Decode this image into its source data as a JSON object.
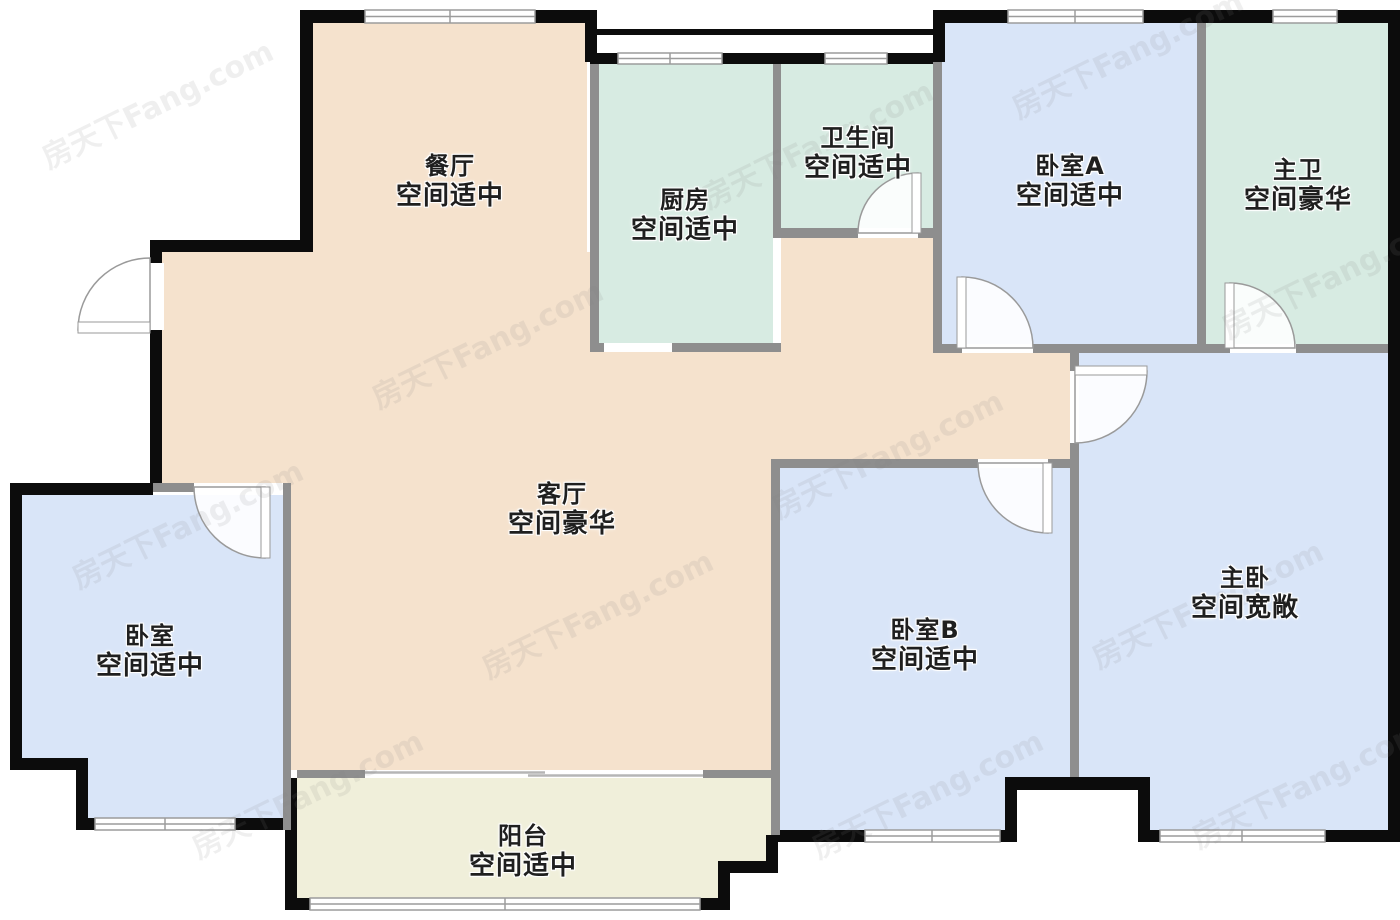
{
  "watermark": "房天下Fang.com",
  "palette": {
    "beige": "#F5E2CD",
    "teal": "#D7EBE2",
    "blue": "#D9E5F8",
    "balcony": "#F0EFDA",
    "wall_black": "#0C0C0C",
    "wall_gray": "#8E8E8E"
  },
  "rooms": [
    {
      "id": "dining",
      "name": "餐厅",
      "size_note": "空间适中"
    },
    {
      "id": "kitchen",
      "name": "厨房",
      "size_note": "空间适中"
    },
    {
      "id": "bathroom",
      "name": "卫生间",
      "size_note": "空间适中"
    },
    {
      "id": "bedroom_a",
      "name": "卧室A",
      "size_note": "空间适中"
    },
    {
      "id": "master_bath",
      "name": "主卫",
      "size_note": "空间豪华"
    },
    {
      "id": "living",
      "name": "客厅",
      "size_note": "空间豪华"
    },
    {
      "id": "bedroom",
      "name": "卧室",
      "size_note": "空间适中"
    },
    {
      "id": "bedroom_b",
      "name": "卧室B",
      "size_note": "空间适中"
    },
    {
      "id": "master_bedroom",
      "name": "主卧",
      "size_note": "空间宽敞"
    },
    {
      "id": "balcony",
      "name": "阳台",
      "size_note": "空间适中"
    }
  ]
}
